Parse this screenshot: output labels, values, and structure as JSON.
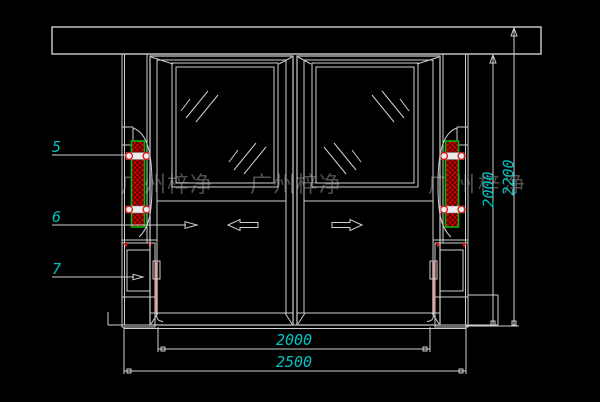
{
  "drawing": {
    "background_color": "#000000",
    "line_color": "#cfcfcf",
    "dimension_color": "#00c2c2",
    "component_red": "#e01010",
    "component_green_border": "#00b400",
    "edge_strip_pink": "#f08080",
    "watermark_gray": "#4f4f4f"
  },
  "watermark": {
    "text": "广州梓净",
    "instances": [
      "广州梓净",
      "广州梓净",
      "广州梓净"
    ]
  },
  "callouts": [
    {
      "label": "5"
    },
    {
      "label": "6"
    },
    {
      "label": "7"
    }
  ],
  "dimensions": {
    "horizontal": [
      {
        "value": "2000"
      },
      {
        "value": "2500"
      }
    ],
    "vertical": [
      {
        "value": "2000"
      },
      {
        "value": "2200"
      }
    ]
  },
  "icons": {
    "left_door_arrow": "arrow-left-outline",
    "right_door_arrow": "arrow-right-outline",
    "leader_arrowhead": "arrow-right-filled"
  }
}
